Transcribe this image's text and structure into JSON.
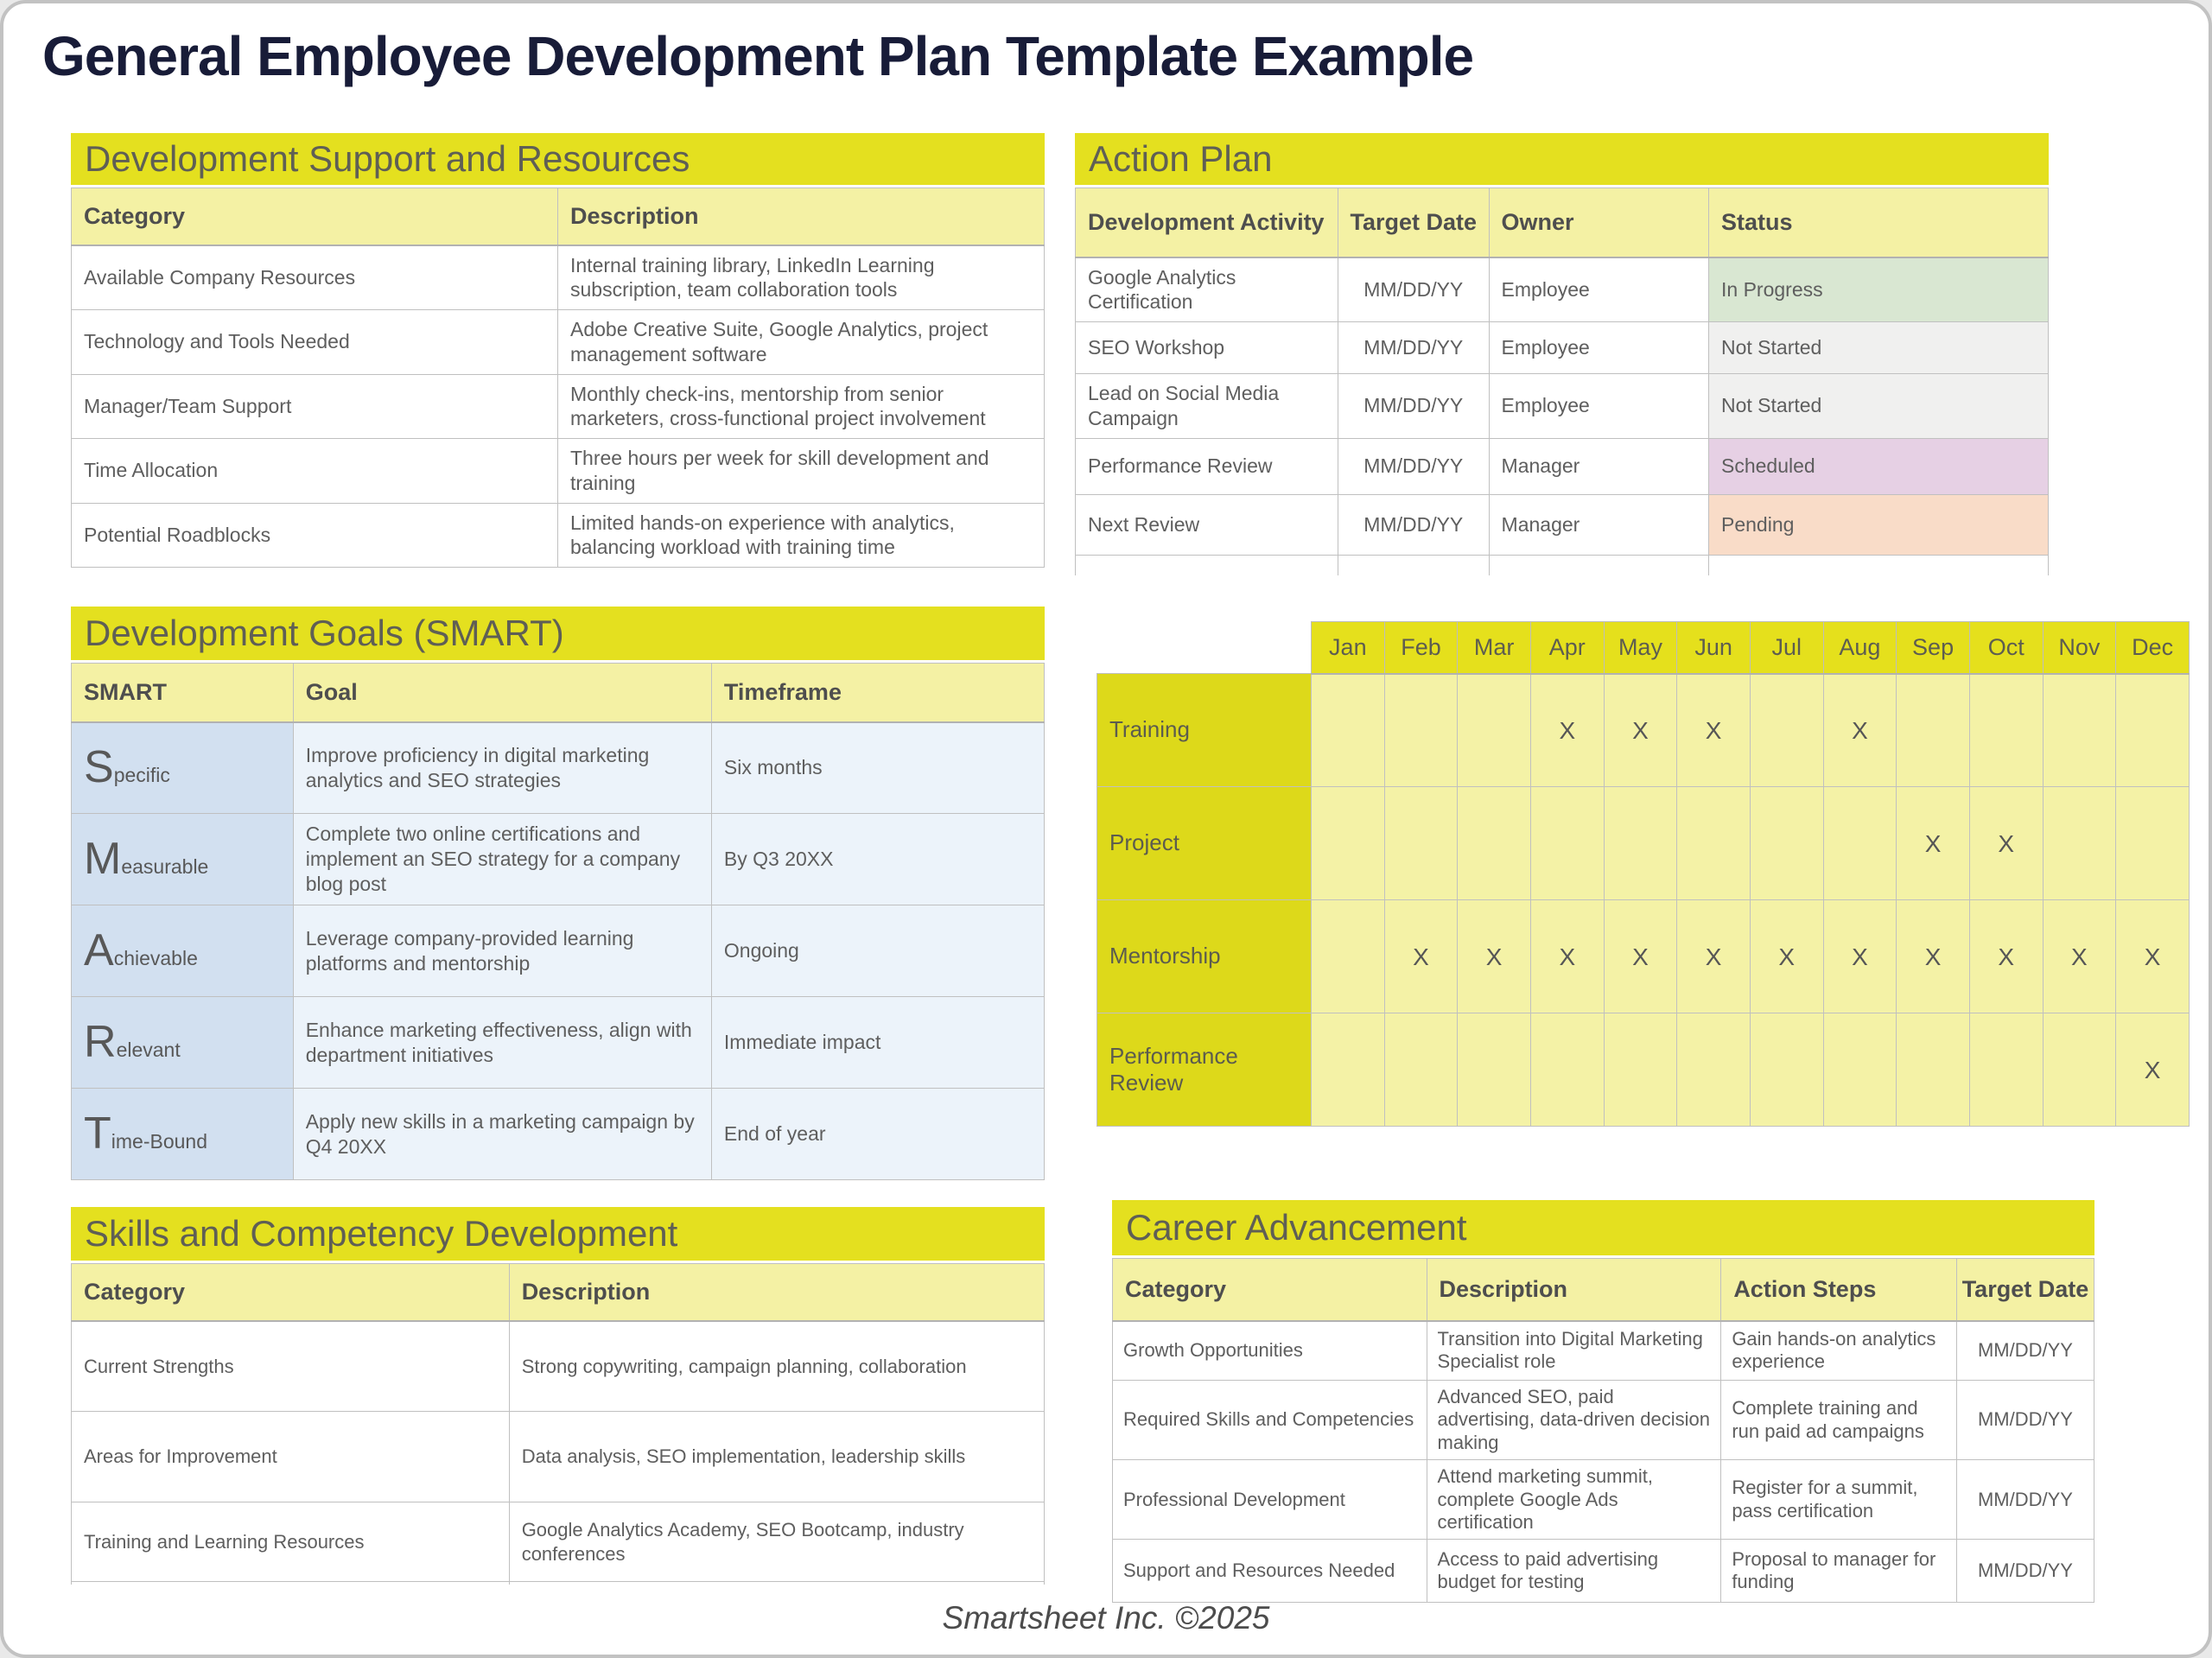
{
  "page": {
    "title": "General Employee Development Plan Template Example",
    "footer": "Smartsheet Inc. ©2025"
  },
  "colors": {
    "band_yellow": "#e4e01f",
    "column_header_yellow": "#f4f1a4",
    "chart_cell_yellow": "#f4f2a6",
    "chart_label_yellow": "#ddd91a",
    "smart_label_blue": "#d2e0f0",
    "smart_cell_blue": "#ecf3fa",
    "title_navy": "#181c38",
    "status_in_progress": "#d9e7d2",
    "status_not_started": "#f0f0ef",
    "status_scheduled": "#e6d0e4",
    "status_pending": "#f9dcc8"
  },
  "dev_support": {
    "title": "Development Support and Resources",
    "col_category": "Category",
    "col_description": "Description",
    "rows": [
      {
        "category": "Available Company Resources",
        "description": "Internal training library, LinkedIn Learning subscription, team collaboration tools"
      },
      {
        "category": "Technology and Tools Needed",
        "description": "Adobe Creative Suite, Google Analytics, project management software"
      },
      {
        "category": "Manager/Team Support",
        "description": "Monthly check-ins, mentorship from senior marketers, cross-functional project involvement"
      },
      {
        "category": "Time Allocation",
        "description": "Three hours per week for skill development and training"
      },
      {
        "category": "Potential Roadblocks",
        "description": "Limited hands-on experience with analytics, balancing workload with training time"
      }
    ]
  },
  "action_plan": {
    "title": "Action Plan",
    "col_activity": "Development Activity",
    "col_target_date": "Target Date",
    "col_owner": "Owner",
    "col_status": "Status",
    "rows": [
      {
        "activity": "Google Analytics Certification",
        "target_date": "MM/DD/YY",
        "owner": "Employee",
        "status": "In Progress",
        "status_bg": "#d9e7d2"
      },
      {
        "activity": "SEO Workshop",
        "target_date": "MM/DD/YY",
        "owner": "Employee",
        "status": "Not Started",
        "status_bg": "#f0f0ef"
      },
      {
        "activity": "Lead on Social Media Campaign",
        "target_date": "MM/DD/YY",
        "owner": "Employee",
        "status": "Not Started",
        "status_bg": "#f0f0ef"
      },
      {
        "activity": "Performance Review",
        "target_date": "MM/DD/YY",
        "owner": "Manager",
        "status": "Scheduled",
        "status_bg": "#e6d0e4"
      },
      {
        "activity": "Next Review",
        "target_date": "MM/DD/YY",
        "owner": "Manager",
        "status": "Pending",
        "status_bg": "#f9dcc8"
      }
    ]
  },
  "dev_goals": {
    "title": "Development Goals (SMART)",
    "col_smart": "SMART",
    "col_goal": "Goal",
    "col_timeframe": "Timeframe",
    "rows": [
      {
        "letter": "S",
        "letter_rest": "pecific",
        "goal": "Improve proficiency in digital marketing analytics and SEO strategies",
        "timeframe": "Six months"
      },
      {
        "letter": "M",
        "letter_rest": "easurable",
        "goal": "Complete two online certifications and implement an SEO strategy for a company blog post",
        "timeframe": "By Q3 20XX"
      },
      {
        "letter": "A",
        "letter_rest": "chievable",
        "goal": "Leverage company-provided learning platforms and mentorship",
        "timeframe": "Ongoing"
      },
      {
        "letter": "R",
        "letter_rest": "elevant",
        "goal": "Enhance marketing effectiveness, align with department initiatives",
        "timeframe": "Immediate impact"
      },
      {
        "letter": "T",
        "letter_rest": "ime-Bound",
        "goal": "Apply new skills in a marketing campaign by Q4 20XX",
        "timeframe": "End of year"
      }
    ]
  },
  "schedule": {
    "months": [
      "Jan",
      "Feb",
      "Mar",
      "Apr",
      "May",
      "Jun",
      "Jul",
      "Aug",
      "Sep",
      "Oct",
      "Nov",
      "Dec"
    ],
    "rows": [
      {
        "label": "Training",
        "cells": [
          "",
          "",
          "",
          "X",
          "X",
          "X",
          "",
          "X",
          "",
          "",
          "",
          ""
        ]
      },
      {
        "label": "Project",
        "cells": [
          "",
          "",
          "",
          "",
          "",
          "",
          "",
          "",
          "X",
          "X",
          "",
          ""
        ]
      },
      {
        "label": "Mentorship",
        "cells": [
          "",
          "X",
          "X",
          "X",
          "X",
          "X",
          "X",
          "X",
          "X",
          "X",
          "X",
          "X"
        ]
      },
      {
        "label": "Performance Review",
        "cells": [
          "",
          "",
          "",
          "",
          "",
          "",
          "",
          "",
          "",
          "",
          "",
          "X"
        ]
      }
    ]
  },
  "skills": {
    "title": "Skills and Competency Development",
    "col_category": "Category",
    "col_description": "Description",
    "rows": [
      {
        "category": "Current Strengths",
        "description": "Strong copywriting, campaign planning, collaboration"
      },
      {
        "category": "Areas for Improvement",
        "description": "Data analysis, SEO implementation, leadership skills"
      },
      {
        "category": "Training and Learning Resources",
        "description": "Google Analytics Academy, SEO Bootcamp, industry conferences"
      }
    ]
  },
  "career": {
    "title": "Career Advancement",
    "col_category": "Category",
    "col_description": "Description",
    "col_action_steps": "Action Steps",
    "col_target_date": "Target Date",
    "rows": [
      {
        "category": "Growth Opportunities",
        "description": "Transition into Digital Marketing Specialist role",
        "action_steps": "Gain hands-on analytics experience",
        "target_date": "MM/DD/YY"
      },
      {
        "category": "Required Skills and Competencies",
        "description": "Advanced SEO, paid advertising, data-driven decision making",
        "action_steps": "Complete training and run paid ad campaigns",
        "target_date": "MM/DD/YY"
      },
      {
        "category": "Professional Development",
        "description": "Attend marketing summit, complete Google Ads certification",
        "action_steps": "Register for a summit, pass certification",
        "target_date": "MM/DD/YY"
      },
      {
        "category": "Support and Resources Needed",
        "description": "Access to paid advertising budget for testing",
        "action_steps": "Proposal to manager for funding",
        "target_date": "MM/DD/YY"
      }
    ]
  }
}
